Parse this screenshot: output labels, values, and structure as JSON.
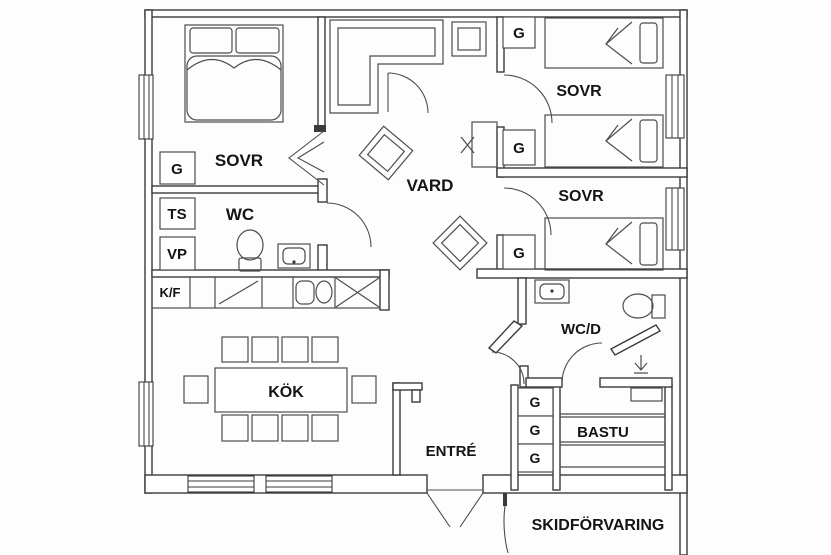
{
  "plan": {
    "type": "floor-plan",
    "colors": {
      "wall_line": "#3a3a3a",
      "furniture_line": "#4d4d4d",
      "text": "#141414",
      "background": "#fdfdfd"
    },
    "labels": {
      "sovr_left": "SOVR",
      "g_left": "G",
      "ts": "TS",
      "vp": "VP",
      "kf": "K/F",
      "wc": "WC",
      "vard": "VARD",
      "kok": "KÖK",
      "entre": "ENTRÉ",
      "sovr_right_top": "SOVR",
      "sovr_right_mid": "SOVR",
      "g_right_1": "G",
      "g_right_2": "G",
      "g_right_3": "G",
      "wcd": "WC/D",
      "g_hall_1": "G",
      "g_hall_2": "G",
      "g_hall_3": "G",
      "bastu": "BASTU",
      "skidforvaring": "SKIDFÖRVARING"
    }
  }
}
